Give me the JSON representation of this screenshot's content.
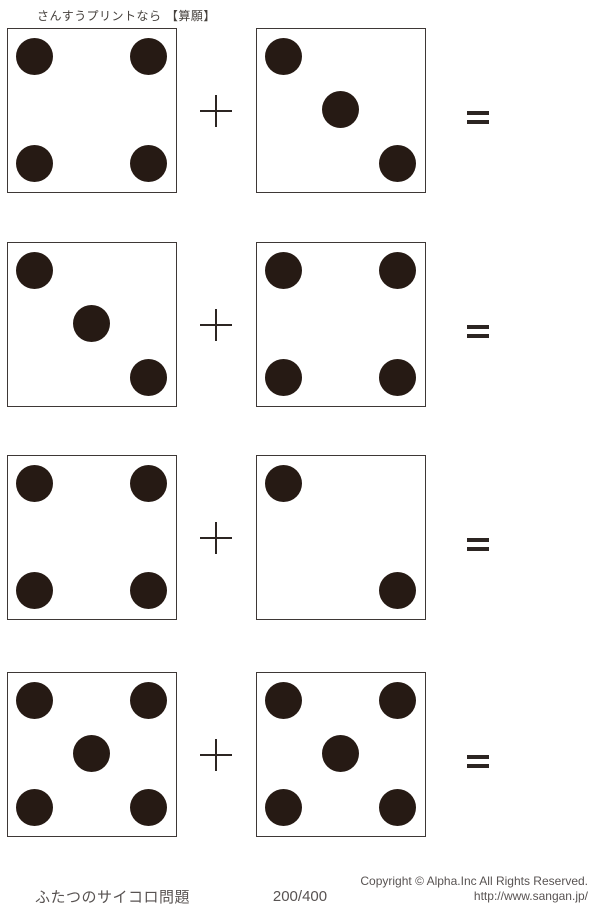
{
  "header": {
    "title": "さんすうプリントなら 【算願】"
  },
  "problems": [
    {
      "left_die_pips": 4,
      "right_die_pips": 3
    },
    {
      "left_die_pips": 3,
      "right_die_pips": 4
    },
    {
      "left_die_pips": 4,
      "right_die_pips": 2
    },
    {
      "left_die_pips": 5,
      "right_die_pips": 5
    }
  ],
  "symbols": {
    "operator": "+",
    "result": "="
  },
  "footer": {
    "worksheet_name": "ふたつのサイコロ問題",
    "page_number": "200/400",
    "copyright": "Copyright © Alpha.Inc All Rights Reserved.",
    "url": "http://www.sangan.jp/"
  },
  "colors": {
    "pip": "#261a14",
    "die_border": "#3e3836",
    "symbol": "#2c2522",
    "text_gray": "#585352",
    "text_dark": "#45403c"
  }
}
